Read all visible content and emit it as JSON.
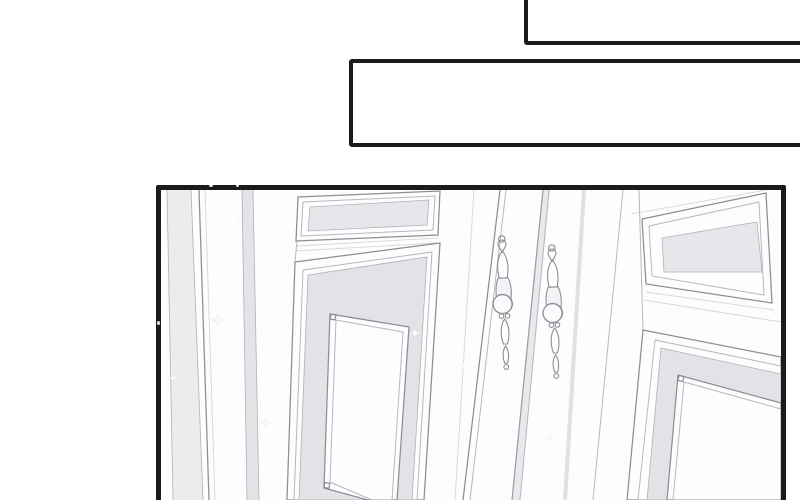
{
  "page_kind": "manga-page",
  "caption_boxes": {
    "top": {
      "text": ""
    },
    "middle": {
      "text": ""
    }
  },
  "illustration": {
    "subject": "ornate-white-double-doors-with-baroque-handles"
  },
  "colors": {
    "ink": "#1b1b1b",
    "paper": "#ffffff",
    "art_paper": "#fdfdfe",
    "line": "#8d8d96",
    "line_soft": "#b6b6bf",
    "panel_inset": "#e7e7eb",
    "panel_band": "#e2e2e7"
  }
}
